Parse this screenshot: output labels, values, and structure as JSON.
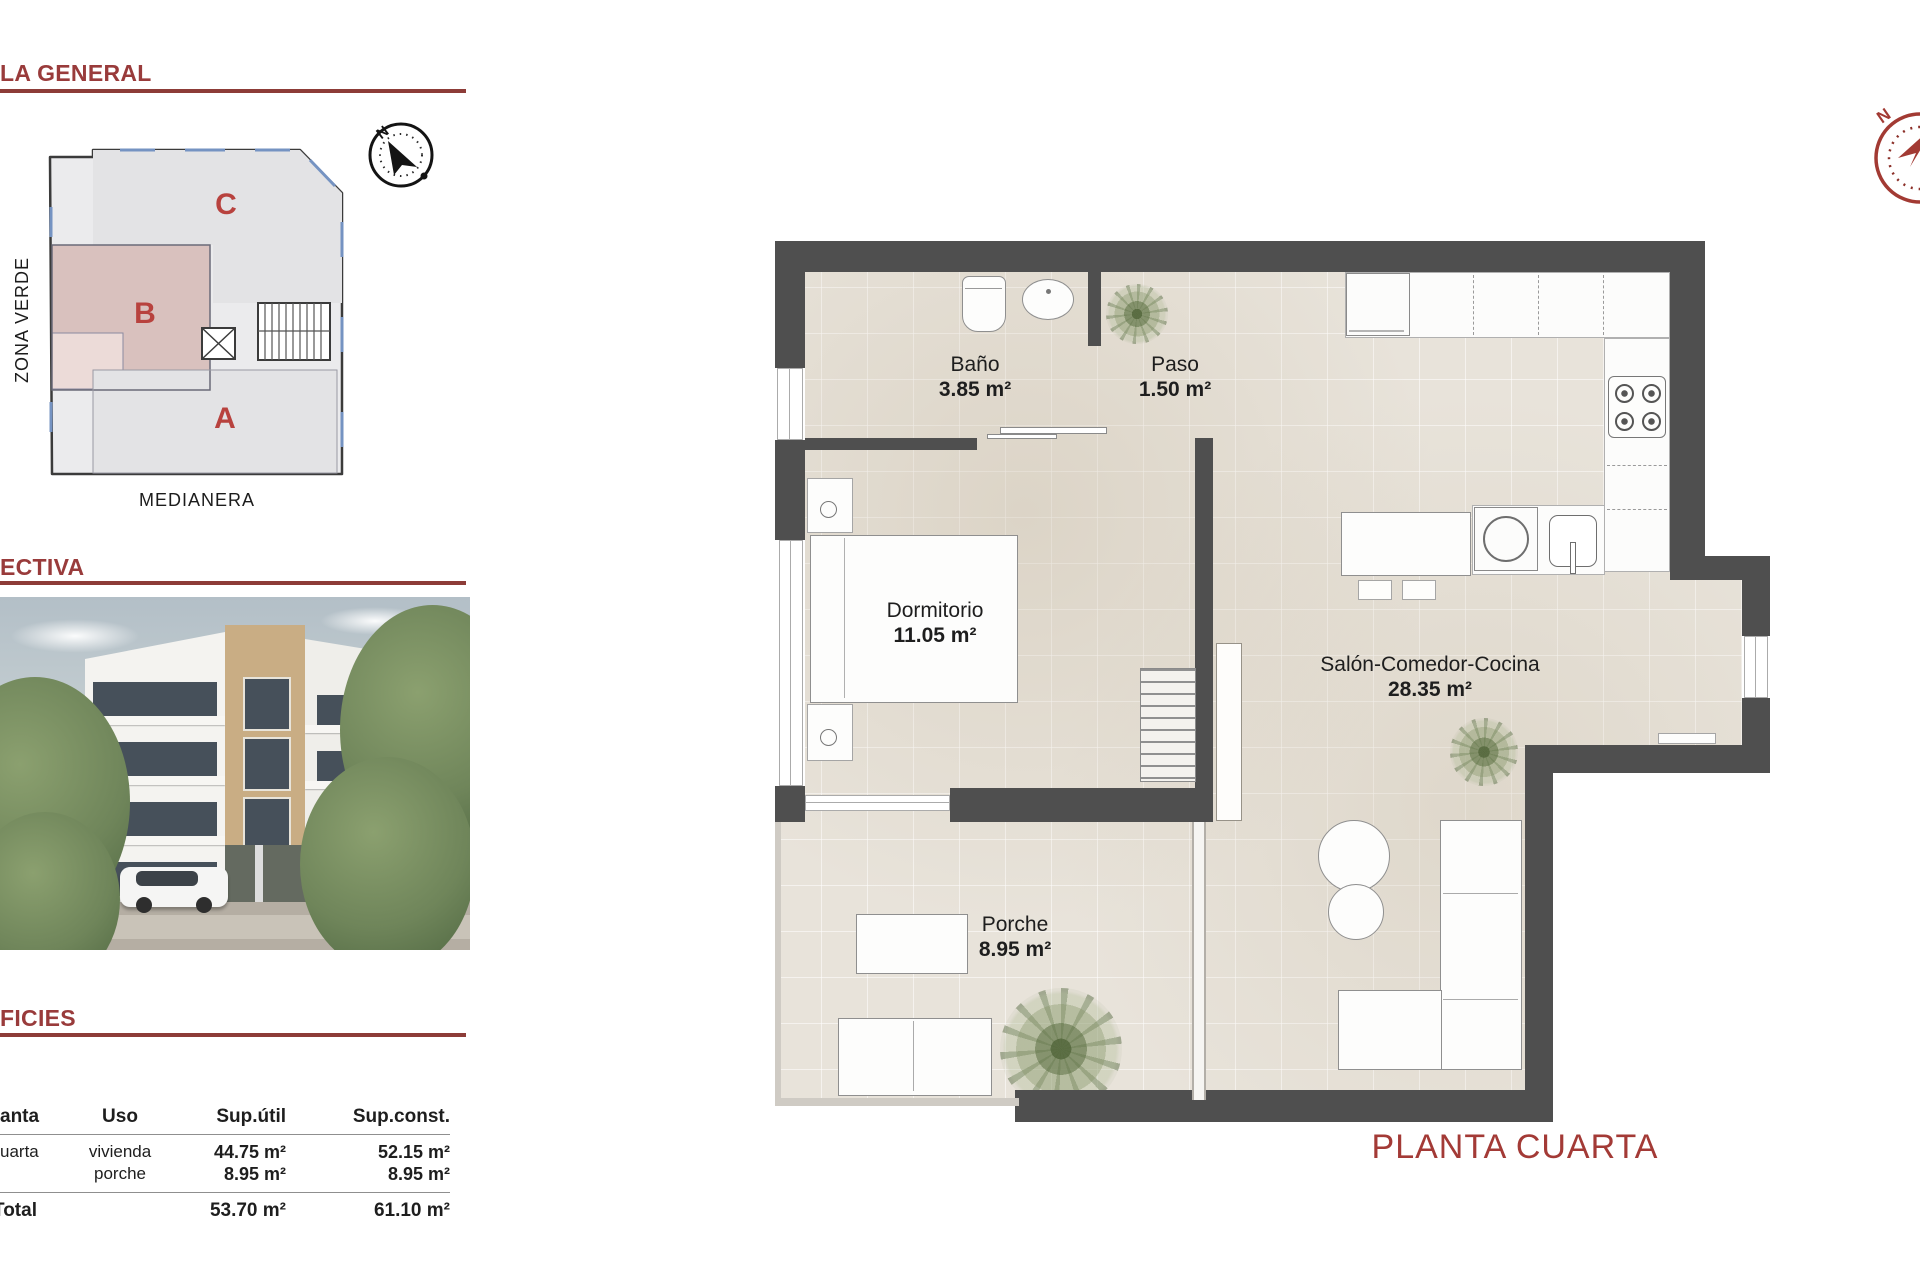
{
  "colors": {
    "accent_red": "#993b3b",
    "underline_red": "#8d3c38",
    "zone_letter_red": "#b8423e",
    "wall_gray": "#4f4f4f",
    "floor_beige": "#e8e3da",
    "zone_b_pink": "#d9c1be",
    "zone_gray": "#e4e4e6"
  },
  "sidebar": {
    "sections": {
      "general": "LA GENERAL",
      "perspectiva": "ECTIVA",
      "superficies": "FICIES"
    },
    "siteplan": {
      "zone_a": "A",
      "zone_b": "B",
      "zone_c": "C",
      "zona_verde": "ZONA VERDE",
      "medianera": "MEDIANERA",
      "compass_n": "N"
    },
    "table": {
      "col_planta": "anta",
      "col_uso": "Uso",
      "col_sup_util": "Sup.útil",
      "col_sup_const": "Sup.const.",
      "row_planta": "uarta",
      "row_uso_1": "vivienda",
      "row_uso_2": "porche",
      "row_util_1": "44.75 m²",
      "row_util_2": "8.95 m²",
      "row_const_1": "52.15 m²",
      "row_const_2": "8.95 m²",
      "total_label": "Total",
      "total_util": "53.70 m²",
      "total_const": "61.10 m²"
    }
  },
  "floorplan": {
    "title": "PLANTA CUARTA",
    "compass_n": "N",
    "rooms": {
      "bano": {
        "name": "Baño",
        "area": "3.85 m²"
      },
      "paso": {
        "name": "Paso",
        "area": "1.50 m²"
      },
      "dormitorio": {
        "name": "Dormitorio",
        "area": "11.05 m²"
      },
      "salon": {
        "name": "Salón-Comedor-Cocina",
        "area": "28.35 m²"
      },
      "porche": {
        "name": "Porche",
        "area": "8.95 m²"
      }
    }
  }
}
